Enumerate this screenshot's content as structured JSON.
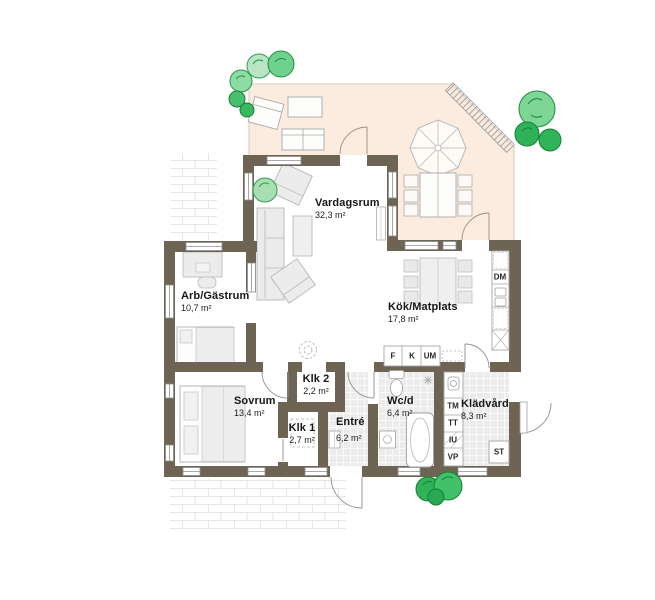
{
  "rooms": [
    {
      "name": "Vardagsrum",
      "area": "32,3 m²"
    },
    {
      "name": "Arb/Gästrum",
      "area": "10,7 m²"
    },
    {
      "name": "Kök/Matplats",
      "area": "17,8 m²"
    },
    {
      "name": "Sovrum",
      "area": "13,4 m²"
    },
    {
      "name": "Klk 2",
      "area": "2,2 m²"
    },
    {
      "name": "Klk 1",
      "area": "2,7 m²"
    },
    {
      "name": "Entré",
      "area": "6,2 m²"
    },
    {
      "name": "Wc/d",
      "area": "6,4 m²"
    },
    {
      "name": "Klädvård",
      "area": "8,3 m²"
    }
  ],
  "appliances": {
    "dm": "DM",
    "f": "F",
    "k": "K",
    "um": "UM",
    "tm": "TM",
    "tt": "TT",
    "iu": "IU",
    "vp": "VP",
    "st": "ST"
  },
  "colors": {
    "wall": "#6d6453",
    "terrace": "#fcecdf",
    "terrace_border": "#dcc9b6",
    "tile_floor": "#ececec",
    "tree_green": "#2fb258",
    "tree_light_green": "#8edca4",
    "furniture_gray": "#ececec"
  }
}
